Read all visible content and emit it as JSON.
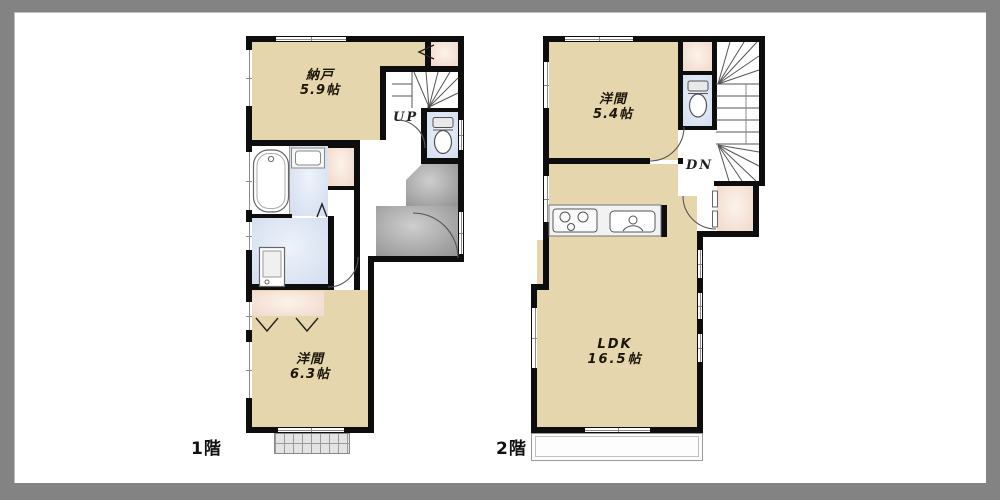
{
  "frame": {
    "outer_color": "#838383",
    "inner_color": "#ffffff"
  },
  "colors": {
    "wall": "#0d0d0d",
    "room": "#e6d6ad",
    "closetIn": "#fdf3ea",
    "closetOut": "#f2dccf",
    "wetIn": "#eef3fb",
    "wetOut": "#d5dff0",
    "entryIn": "#cecece",
    "entryOut": "#949494",
    "frameOuter": "#838383",
    "frameInner": "#ffffff"
  },
  "floor1": {
    "label": "1階",
    "stair_label": "UP",
    "rooms": {
      "storage": {
        "name": "納戸",
        "size": "5.9帖"
      },
      "western": {
        "name": "洋間",
        "size": "6.3帖"
      }
    }
  },
  "floor2": {
    "label": "2階",
    "stair_label": "DN",
    "rooms": {
      "western": {
        "name": "洋間",
        "size": "5.4帖"
      },
      "ldk": {
        "name": "LDK",
        "size": "16.5帖"
      }
    }
  }
}
